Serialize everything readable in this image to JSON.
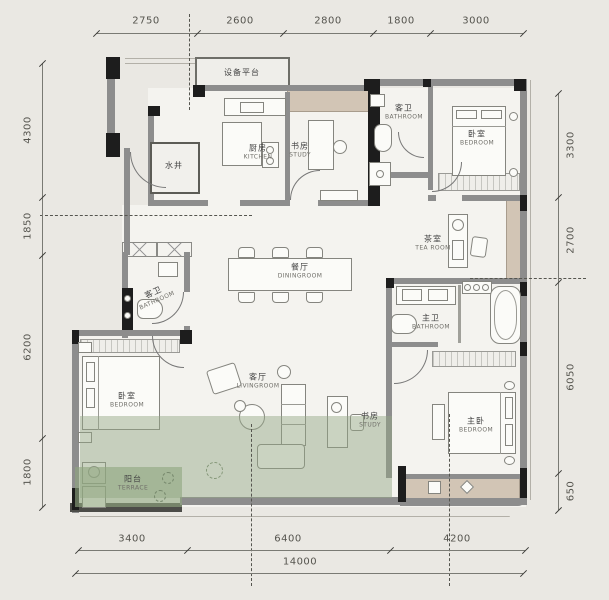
{
  "plan": {
    "title": "residential floor plan",
    "colors": {
      "background": "#eae8e3",
      "room_fill": "#f4f3ef",
      "wall_gray": "#8d8d8d",
      "wall_black": "#1d1d1d",
      "highlight_green": "#94a886",
      "bay_tan": "#d2c5b5",
      "dim_text": "#55544e"
    },
    "rooms": [
      {
        "id": "equipment-platform",
        "zh": "设备平台",
        "en": ""
      },
      {
        "id": "kitchen",
        "zh": "厨房",
        "en": "KITCHEN"
      },
      {
        "id": "water-shaft",
        "zh": "水井",
        "en": ""
      },
      {
        "id": "study-top",
        "zh": "书房",
        "en": "STUDY"
      },
      {
        "id": "guest-bath-top",
        "zh": "客卫",
        "en": "BATHROOM"
      },
      {
        "id": "bedroom-top-right",
        "zh": "卧室",
        "en": "BEDROOM"
      },
      {
        "id": "tea-room",
        "zh": "茶室",
        "en": "TEA ROOM"
      },
      {
        "id": "dining-room",
        "zh": "餐厅",
        "en": "DININGROOM"
      },
      {
        "id": "guest-bath-mid",
        "zh": "客卫",
        "en": "BATHROOM"
      },
      {
        "id": "bedroom-left",
        "zh": "卧室",
        "en": "BEDROOM"
      },
      {
        "id": "terrace",
        "zh": "阳台",
        "en": "TERRACE"
      },
      {
        "id": "living-room",
        "zh": "客厅",
        "en": "LIVINGROOM"
      },
      {
        "id": "study-bottom",
        "zh": "书房",
        "en": "STUDY"
      },
      {
        "id": "master-bath",
        "zh": "主卫",
        "en": "BATHROOM"
      },
      {
        "id": "master-bedroom",
        "zh": "主卧",
        "en": "BEDROOM"
      }
    ],
    "dimensions": {
      "top": [
        "2750",
        "2600",
        "2800",
        "1800",
        "3000"
      ],
      "left": [
        "4300",
        "1850",
        "6200",
        "1800"
      ],
      "right": [
        "3300",
        "2700",
        "6050",
        "650"
      ],
      "bottom": [
        "3400",
        "6400",
        "4200"
      ],
      "total_width": "14000"
    }
  }
}
